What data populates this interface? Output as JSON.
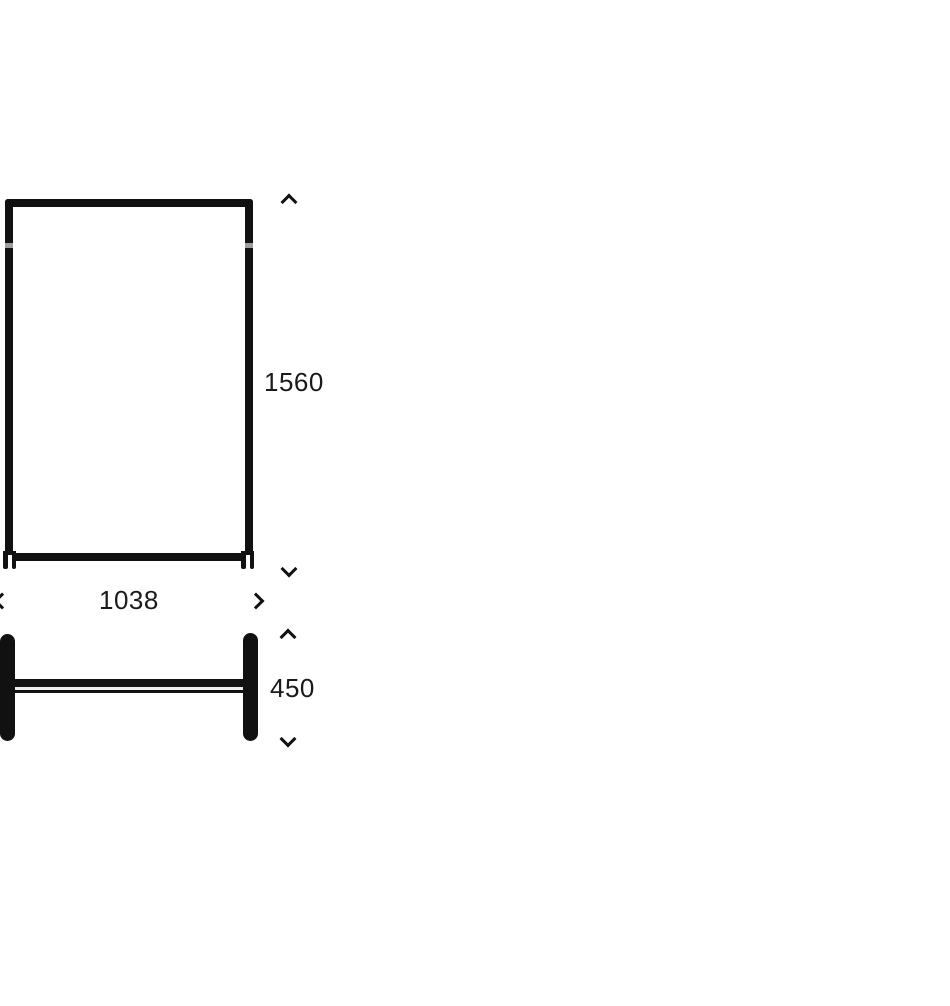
{
  "colors": {
    "background": "#ffffff",
    "line": "#111111",
    "text": "#1a1a1a"
  },
  "dimensions": {
    "height": {
      "value": "1560"
    },
    "width": {
      "value": "1038"
    },
    "depth": {
      "value": "450"
    }
  }
}
